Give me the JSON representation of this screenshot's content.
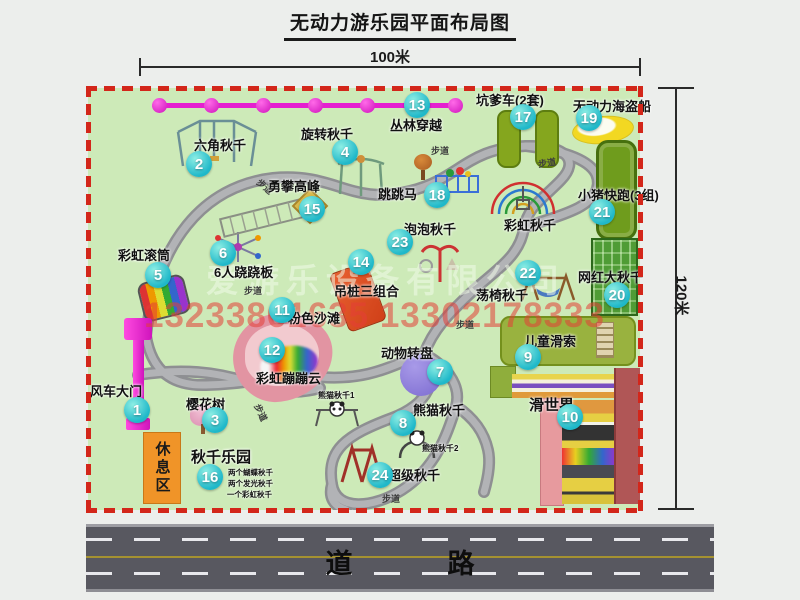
{
  "title": "无动力游乐园平面布局图",
  "dimensions": {
    "width": "100米",
    "height": "120米"
  },
  "road": {
    "label": "道　路"
  },
  "watermarks": {
    "company": "爱游乐设备有限公司",
    "phone": "13233861635 13302178333"
  },
  "rest_area": "休息区",
  "walkway_label": "步道",
  "extra_labels": {
    "rainbow_swing": "彩虹秋千"
  },
  "panda_sub_labels": [
    "熊猫秋千1",
    "熊猫秋千2"
  ],
  "swing_park_details": [
    "两个蝴蝶秋千",
    "两个发光秋千",
    "一个彩虹秋千"
  ],
  "attractions": [
    {
      "num": "1",
      "label": "风车大门"
    },
    {
      "num": "2",
      "label": "六角秋千"
    },
    {
      "num": "3",
      "label": "樱花树"
    },
    {
      "num": "4",
      "label": "旋转秋千"
    },
    {
      "num": "5",
      "label": "彩虹滚筒"
    },
    {
      "num": "6",
      "label": "6人跷跷板"
    },
    {
      "num": "7",
      "label": "动物转盘"
    },
    {
      "num": "8",
      "label": "熊猫秋千"
    },
    {
      "num": "9",
      "label": "儿童滑索"
    },
    {
      "num": "10",
      "label": "滑世界"
    },
    {
      "num": "11",
      "label": "粉色沙滩"
    },
    {
      "num": "12",
      "label": "彩虹蹦蹦云"
    },
    {
      "num": "13",
      "label": "丛林穿越"
    },
    {
      "num": "14",
      "label": "吊桩三组合"
    },
    {
      "num": "15",
      "label": "勇攀高峰"
    },
    {
      "num": "16",
      "label": "秋千乐园"
    },
    {
      "num": "17",
      "label": "坑爹车(2套)"
    },
    {
      "num": "18",
      "label": "跳跳马"
    },
    {
      "num": "19",
      "label": "无动力海盗船"
    },
    {
      "num": "20",
      "label": "网红大秋千"
    },
    {
      "num": "21",
      "label": "小猪快跑(3组)"
    },
    {
      "num": "22",
      "label": "荡椅秋千"
    },
    {
      "num": "23",
      "label": "泡泡秋千"
    },
    {
      "num": "24",
      "label": "超级秋千"
    }
  ],
  "colors": {
    "map_green": "#cdeab8",
    "border_red": "#d3261a",
    "badge_teal": "#25c2cd",
    "gate_magenta": "#e51fd0",
    "road_gray": "#585860",
    "path_gray": "#aeafb2",
    "watermark_red": "#e43e37"
  }
}
